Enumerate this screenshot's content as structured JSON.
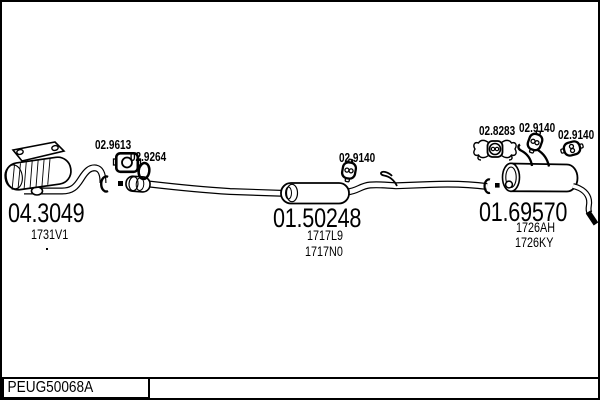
{
  "sections": {
    "front": {
      "part_number": "04.3049",
      "variants": [
        "1731V1"
      ],
      "gasket_label": "02.9613",
      "clamp_label": "02.9264"
    },
    "middle": {
      "part_number": "01.50248",
      "variants": [
        "1717L9",
        "1717N0"
      ],
      "mount_label": "02.9140"
    },
    "rear": {
      "part_number": "01.69570",
      "variants": [
        "1726AH",
        "1726KY"
      ],
      "bracket_label": "02.8283",
      "mount_label_1": "02.9140",
      "mount_label_2": "02.9140"
    }
  },
  "footer": {
    "catalog_code": "PEUG50068A"
  },
  "colors": {
    "ink": "#000000",
    "paper": "#ffffff"
  }
}
